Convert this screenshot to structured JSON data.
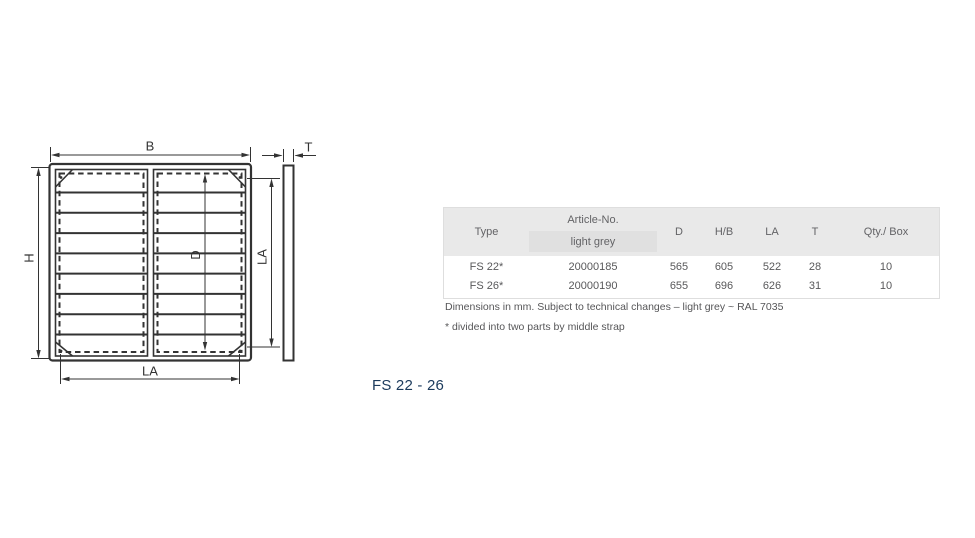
{
  "drawing": {
    "title": "FS 22 - 26",
    "labels": {
      "width": "B",
      "height": "H",
      "inner_diagonal": "D",
      "inner_height": "LA",
      "inner_width": "LA",
      "thickness": "T"
    }
  },
  "table": {
    "headers": {
      "type": "Type",
      "article": "Article-No.",
      "article_sub": "light grey",
      "d": "D",
      "hb": "H/B",
      "la": "LA",
      "t": "T",
      "qty": "Qty./ Box"
    },
    "rows": [
      {
        "type": "FS 22*",
        "article": "20000185",
        "d": "565",
        "hb": "605",
        "la": "522",
        "t": "28",
        "qty": "10"
      },
      {
        "type": "FS 26*",
        "article": "20000190",
        "d": "655",
        "hb": "696",
        "la": "626",
        "t": "31",
        "qty": "10"
      }
    ],
    "notes": [
      "Dimensions in mm. Subject to technical changes – light grey ~ RAL 7035",
      "* divided into two parts by middle strap"
    ]
  },
  "colors": {
    "accent_title": "#1b3a5c",
    "table_header_bg": "#e9e9e9",
    "light_grey_cell_bg": "#e0e0e0",
    "drawing_line": "#333333",
    "table_text": "#58585a"
  }
}
